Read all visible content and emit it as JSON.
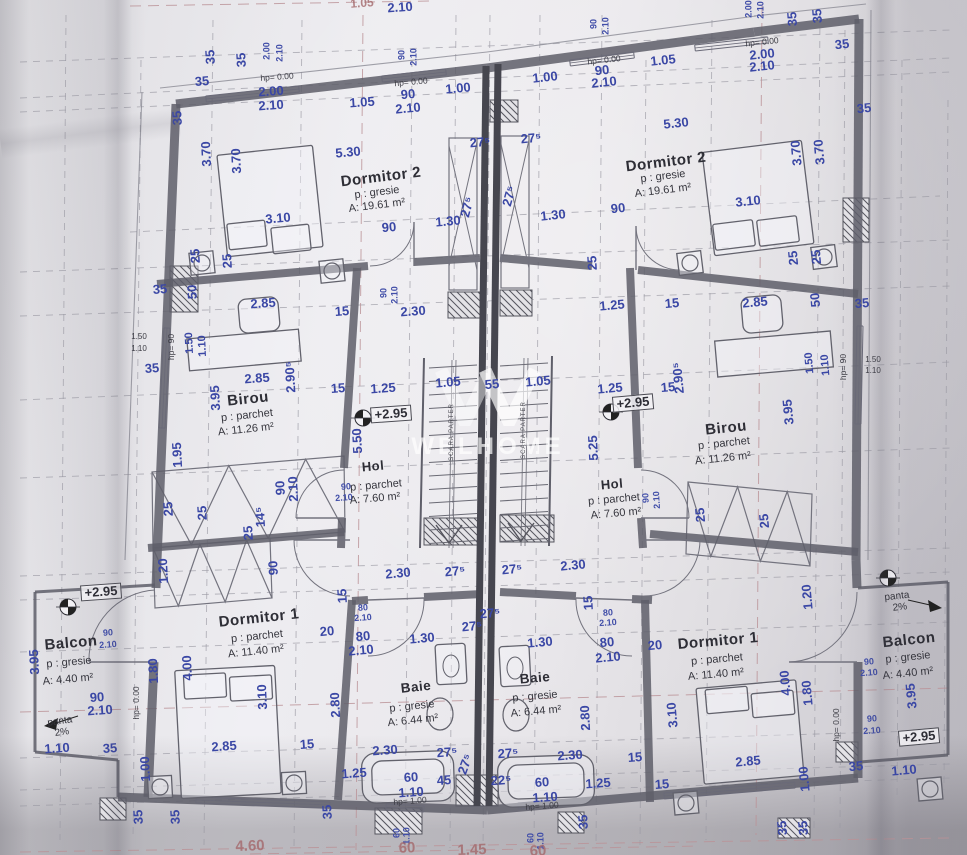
{
  "sheet": {
    "watermark": "WELHOME",
    "stair_label": "SCARA PARTER",
    "level_mark": "+2.95"
  },
  "rooms": [
    {
      "name": "Dormitor 2",
      "floor": "p : gresie",
      "area": "A: 19.61 m²"
    },
    {
      "name": "Birou",
      "floor": "p : parchet",
      "area": "A: 11.26 m²"
    },
    {
      "name": "Hol",
      "floor": "p : parchet",
      "area": "A: 7.60 m²"
    },
    {
      "name": "Dormitor 1",
      "floor": "p : parchet",
      "area": "A: 11.40 m²"
    },
    {
      "name": "Baie",
      "floor": "p : gresie",
      "area": "A: 6.44 m²"
    },
    {
      "name": "Balcon",
      "floor": "p : gresie",
      "area": "A: 4.40 m²"
    }
  ],
  "colors": {
    "dim_blue": "#3a47a5",
    "room_text": "#2e2e36",
    "wall": "#5f5f6a",
    "grid_gray": "#9a99a3",
    "grid_red": "#bb9297",
    "red_dim": "#a4696c"
  },
  "labels": [
    [
      "1.05",
      362,
      3,
      -4,
      "red",
      12
    ],
    [
      "2.10",
      400,
      7,
      -4,
      "d"
    ],
    [
      "35",
      210,
      57,
      -93,
      "d"
    ],
    [
      "35",
      241,
      60,
      -93,
      "d"
    ],
    [
      "2.00",
      267,
      51,
      -90,
      "ds"
    ],
    [
      "2.10",
      280,
      53,
      -90,
      "ds"
    ],
    [
      "35",
      202,
      81,
      -4,
      "d"
    ],
    [
      "hp= 0.00",
      277,
      77,
      -4,
      "h"
    ],
    [
      "2.00",
      271,
      91,
      -4,
      "d"
    ],
    [
      "2.10",
      271,
      105,
      -4,
      "d"
    ],
    [
      "1.05",
      362,
      102,
      -4,
      "d"
    ],
    [
      "90",
      402,
      55,
      -90,
      "ds"
    ],
    [
      "2.10",
      414,
      57,
      -90,
      "ds"
    ],
    [
      "hp= 0.00",
      411,
      82,
      -5,
      "h"
    ],
    [
      "90",
      408,
      94,
      -5,
      "d"
    ],
    [
      "2.10",
      408,
      108,
      -5,
      "d"
    ],
    [
      "1.00",
      458,
      88,
      -5,
      "d"
    ],
    [
      "1.00",
      545,
      77,
      -6,
      "d"
    ],
    [
      "90",
      594,
      24,
      -90,
      "ds"
    ],
    [
      "2.10",
      606,
      26,
      -90,
      "ds"
    ],
    [
      "hp= 0.00",
      604,
      60,
      -6,
      "h"
    ],
    [
      "90",
      602,
      70,
      -6,
      "d"
    ],
    [
      "2.10",
      604,
      82,
      -6,
      "d"
    ],
    [
      "1.05",
      663,
      60,
      -6,
      "d"
    ],
    [
      "2.00",
      749,
      9,
      -90,
      "ds"
    ],
    [
      "2.10",
      761,
      10,
      -90,
      "ds"
    ],
    [
      "hp= 0.00",
      762,
      42,
      -6,
      "h"
    ],
    [
      "2.00",
      762,
      54,
      -6,
      "d"
    ],
    [
      "2.10",
      762,
      66,
      -6,
      "d"
    ],
    [
      "35",
      792,
      19,
      -94,
      "d"
    ],
    [
      "35",
      817,
      16,
      -94,
      "d"
    ],
    [
      "35",
      842,
      44,
      -6,
      "d"
    ],
    [
      "35",
      864,
      108,
      -6,
      "d"
    ],
    [
      "5.30",
      676,
      123,
      -6,
      "d"
    ],
    [
      "35",
      177,
      118,
      -93,
      "d"
    ],
    [
      "3.70",
      206,
      154,
      -93,
      "d"
    ],
    [
      "3.70",
      236,
      161,
      -93,
      "d"
    ],
    [
      "5.30",
      348,
      152,
      -5,
      "d"
    ],
    [
      "Dormitor 2",
      381,
      177,
      -7,
      "r"
    ],
    [
      "p : gresie",
      377,
      193,
      -7,
      "rs"
    ],
    [
      "A: 19.61 m²",
      377,
      206,
      -7,
      "rs"
    ],
    [
      "3.10",
      278,
      218,
      -5,
      "d"
    ],
    [
      "90",
      389,
      227,
      -5,
      "d"
    ],
    [
      "1.30",
      448,
      221,
      -5,
      "d"
    ],
    [
      "27⁵",
      480,
      142,
      -5,
      "d"
    ],
    [
      "27⁵",
      531,
      138,
      -5,
      "d"
    ],
    [
      "27⁵",
      467,
      207,
      -75,
      "d"
    ],
    [
      "27⁵",
      509,
      196,
      -75,
      "d"
    ],
    [
      "Dormitor 2",
      666,
      162,
      -7,
      "r"
    ],
    [
      "p : gresie",
      663,
      177,
      -7,
      "rs"
    ],
    [
      "A: 19.61 m²",
      663,
      191,
      -7,
      "rs"
    ],
    [
      "1.30",
      553,
      215,
      -6,
      "d"
    ],
    [
      "90",
      618,
      208,
      -6,
      "d"
    ],
    [
      "3.10",
      748,
      201,
      -6,
      "d"
    ],
    [
      "3.70",
      796,
      153,
      -95,
      "d"
    ],
    [
      "3.70",
      819,
      152,
      -95,
      "d"
    ],
    [
      "25",
      195,
      256,
      -93,
      "d"
    ],
    [
      "25",
      227,
      261,
      -93,
      "d"
    ],
    [
      "25",
      592,
      263,
      -93,
      "d"
    ],
    [
      "25",
      793,
      258,
      -95,
      "d"
    ],
    [
      "25",
      816,
      257,
      -95,
      "d"
    ],
    [
      "35",
      160,
      289,
      -4,
      "d"
    ],
    [
      "50",
      192,
      292,
      -93,
      "d"
    ],
    [
      "2.85",
      263,
      303,
      -4,
      "d"
    ],
    [
      "15",
      342,
      311,
      -4,
      "d"
    ],
    [
      "2.30",
      413,
      311,
      -4,
      "d"
    ],
    [
      "90",
      384,
      293,
      -90,
      "ds"
    ],
    [
      "2.10",
      395,
      295,
      -90,
      "ds"
    ],
    [
      "1.25",
      612,
      305,
      -5,
      "d"
    ],
    [
      "15",
      672,
      303,
      -5,
      "d"
    ],
    [
      "2.85",
      755,
      302,
      -5,
      "d"
    ],
    [
      "50",
      815,
      300,
      -95,
      "d"
    ],
    [
      "35",
      862,
      303,
      -5,
      "d"
    ],
    [
      "1.50",
      139,
      337,
      0,
      "tiny"
    ],
    [
      "1.10",
      139,
      349,
      0,
      "tiny"
    ],
    [
      "hp= 90",
      171,
      347,
      -90,
      "h"
    ],
    [
      "1.50",
      190,
      343,
      -93,
      "d",
      11
    ],
    [
      "1.10",
      203,
      346,
      -93,
      "d",
      11
    ],
    [
      "35",
      152,
      368,
      -4,
      "d"
    ],
    [
      "2.85",
      257,
      378,
      -4,
      "d"
    ],
    [
      "2.90⁵",
      290,
      377,
      -93,
      "d"
    ],
    [
      "3.95",
      215,
      398,
      -93,
      "d"
    ],
    [
      "15",
      338,
      388,
      -4,
      "d"
    ],
    [
      "1.25",
      383,
      388,
      -4,
      "d"
    ],
    [
      "Birou",
      248,
      399,
      -6,
      "r"
    ],
    [
      "p : parchet",
      247,
      416,
      -6,
      "rs"
    ],
    [
      "A: 11.26 m²",
      246,
      430,
      -6,
      "rs"
    ],
    [
      "+2.95",
      391,
      414,
      -4,
      "box"
    ],
    [
      "1.05",
      448,
      382,
      -5,
      "d"
    ],
    [
      "55",
      492,
      384,
      -5,
      "d"
    ],
    [
      "1.05",
      538,
      381,
      -5,
      "d"
    ],
    [
      "1.25",
      610,
      388,
      -5,
      "d"
    ],
    [
      "+2.95",
      633,
      403,
      -5,
      "box"
    ],
    [
      "15",
      668,
      387,
      -5,
      "d"
    ],
    [
      "2.90⁵",
      678,
      378,
      -95,
      "d"
    ],
    [
      "1.50",
      810,
      363,
      -95,
      "d",
      11
    ],
    [
      "1.10",
      826,
      365,
      -95,
      "d",
      11
    ],
    [
      "hp= 90",
      843,
      367,
      -90,
      "h"
    ],
    [
      "1.50",
      873,
      360,
      0,
      "tiny"
    ],
    [
      "1.10",
      873,
      371,
      0,
      "tiny"
    ],
    [
      "3.95",
      788,
      412,
      -95,
      "d"
    ],
    [
      "Birou",
      726,
      428,
      -6,
      "r"
    ],
    [
      "p : parchet",
      724,
      444,
      -6,
      "rs"
    ],
    [
      "A: 11.26 m²",
      723,
      459,
      -6,
      "rs"
    ],
    [
      "5.50",
      357,
      441,
      -93,
      "d"
    ],
    [
      "5.25",
      593,
      448,
      -93,
      "d"
    ],
    [
      "Hol",
      373,
      466,
      -5,
      "r",
      13
    ],
    [
      "90",
      346,
      487,
      -4,
      "ds"
    ],
    [
      "2.10",
      344,
      498,
      -4,
      "ds"
    ],
    [
      "p : parchet",
      376,
      486,
      -5,
      "rs"
    ],
    [
      "A: 7.60 m²",
      375,
      499,
      -5,
      "rs"
    ],
    [
      "Hol",
      612,
      484,
      -5,
      "r",
      13
    ],
    [
      "p : parchet",
      614,
      500,
      -5,
      "rs"
    ],
    [
      "A: 7.60 m²",
      616,
      514,
      -5,
      "rs"
    ],
    [
      "1.95",
      177,
      455,
      -93,
      "d"
    ],
    [
      "SCARA PARTER",
      452,
      432,
      -90,
      "st"
    ],
    [
      "SCARA PARTER",
      524,
      430,
      -90,
      "st"
    ],
    [
      "25",
      168,
      509,
      -93,
      "d"
    ],
    [
      "25",
      202,
      513,
      -93,
      "d"
    ],
    [
      "14⁵",
      260,
      517,
      -93,
      "d"
    ],
    [
      "25",
      248,
      533,
      -93,
      "d"
    ],
    [
      "90",
      280,
      488,
      -93,
      "d"
    ],
    [
      "2.10",
      293,
      489,
      -93,
      "d"
    ],
    [
      "90",
      273,
      568,
      -93,
      "d"
    ],
    [
      "1.20",
      163,
      571,
      -93,
      "d"
    ],
    [
      "2.30",
      398,
      573,
      -5,
      "d"
    ],
    [
      "27⁵",
      455,
      571,
      -5,
      "d"
    ],
    [
      "27⁵",
      512,
      569,
      -5,
      "d"
    ],
    [
      "2.30",
      573,
      565,
      -5,
      "d"
    ],
    [
      "90",
      646,
      498,
      -93,
      "ds"
    ],
    [
      "2.10",
      657,
      500,
      -93,
      "ds"
    ],
    [
      "25",
      700,
      515,
      -95,
      "d"
    ],
    [
      "25",
      764,
      521,
      -95,
      "d"
    ],
    [
      "1.20",
      807,
      597,
      -95,
      "d"
    ],
    [
      "15",
      342,
      596,
      -93,
      "d"
    ],
    [
      "80",
      363,
      608,
      -4,
      "ds"
    ],
    [
      "2.10",
      363,
      618,
      -4,
      "ds"
    ],
    [
      "15",
      588,
      603,
      -93,
      "d"
    ],
    [
      "80",
      608,
      613,
      -4,
      "ds"
    ],
    [
      "2.10",
      608,
      623,
      -4,
      "ds"
    ],
    [
      "Dormitor 1",
      259,
      618,
      -6,
      "r"
    ],
    [
      "p : parchet",
      257,
      637,
      -6,
      "rs"
    ],
    [
      "A: 11.40 m²",
      256,
      652,
      -6,
      "rs"
    ],
    [
      "20",
      327,
      631,
      -5,
      "d"
    ],
    [
      "80",
      363,
      636,
      -5,
      "d"
    ],
    [
      "2.10",
      361,
      650,
      -5,
      "d"
    ],
    [
      "1.30",
      422,
      638,
      -5,
      "d"
    ],
    [
      "27⁵",
      490,
      613,
      -5,
      "d"
    ],
    [
      "27⁵",
      472,
      626,
      -5,
      "d"
    ],
    [
      "1.30",
      540,
      642,
      -5,
      "d"
    ],
    [
      "80",
      607,
      642,
      -5,
      "d"
    ],
    [
      "2.10",
      608,
      657,
      -5,
      "d"
    ],
    [
      "20",
      655,
      645,
      -5,
      "d"
    ],
    [
      "Dormitor 1",
      718,
      641,
      -5,
      "r"
    ],
    [
      "p : parchet",
      717,
      660,
      -5,
      "rs"
    ],
    [
      "A: 11.40 m²",
      716,
      675,
      -5,
      "rs"
    ],
    [
      "1.80",
      153,
      671,
      -93,
      "d"
    ],
    [
      "4.00",
      187,
      668,
      -93,
      "d"
    ],
    [
      "3.10",
      262,
      697,
      -93,
      "d"
    ],
    [
      "2.80",
      335,
      705,
      -93,
      "d"
    ],
    [
      "Baie",
      416,
      687,
      -6,
      "r",
      13.5
    ],
    [
      "p : gresie",
      412,
      707,
      -6,
      "rs"
    ],
    [
      "A: 6.44 m²",
      413,
      721,
      -6,
      "rs"
    ],
    [
      "Baie",
      535,
      678,
      -5,
      "r",
      13.5
    ],
    [
      "p : gresie",
      535,
      697,
      -5,
      "rs"
    ],
    [
      "A: 6.44 m²",
      536,
      712,
      -5,
      "rs"
    ],
    [
      "2.80",
      585,
      718,
      -93,
      "d"
    ],
    [
      "3.10",
      672,
      715,
      -95,
      "d"
    ],
    [
      "4.00",
      785,
      683,
      -95,
      "d"
    ],
    [
      "1.80",
      807,
      693,
      -95,
      "d"
    ],
    [
      "hp= 0.00",
      836,
      725,
      -90,
      "h"
    ],
    [
      "hp= 0.00",
      136,
      703,
      -90,
      "h"
    ],
    [
      "+2.95",
      101,
      592,
      -4,
      "box"
    ],
    [
      "Balcon",
      71,
      643,
      -5,
      "r"
    ],
    [
      "90",
      108,
      633,
      -4,
      "ds"
    ],
    [
      "2.10",
      108,
      645,
      -4,
      "ds"
    ],
    [
      "p : gresie",
      69,
      663,
      -5,
      "rs"
    ],
    [
      "A: 4.40 m²",
      68,
      680,
      -5,
      "rs"
    ],
    [
      "3.95",
      34,
      662,
      -93,
      "d"
    ],
    [
      "90",
      97,
      697,
      -4,
      "d"
    ],
    [
      "2.10",
      100,
      710,
      -4,
      "d"
    ],
    [
      "panta",
      60,
      722,
      -8,
      "rs",
      10
    ],
    [
      "2%",
      62,
      733,
      -8,
      "rs",
      10
    ],
    [
      "1.10",
      57,
      748,
      -4,
      "d"
    ],
    [
      "35",
      110,
      748,
      -4,
      "d"
    ],
    [
      "1.00",
      145,
      769,
      -93,
      "d"
    ],
    [
      "panta",
      897,
      597,
      -6,
      "rs",
      10
    ],
    [
      "2%",
      900,
      608,
      -6,
      "rs",
      10
    ],
    [
      "Balcon",
      909,
      640,
      -6,
      "r"
    ],
    [
      "90",
      869,
      662,
      -4,
      "ds"
    ],
    [
      "2.10",
      869,
      673,
      -4,
      "ds"
    ],
    [
      "p : gresie",
      908,
      658,
      -6,
      "rs"
    ],
    [
      "A: 4.40 m²",
      908,
      674,
      -6,
      "rs"
    ],
    [
      "3.95",
      911,
      696,
      -95,
      "d"
    ],
    [
      "90",
      872,
      719,
      -4,
      "ds"
    ],
    [
      "2.10",
      872,
      731,
      -4,
      "ds"
    ],
    [
      "+2.95",
      919,
      737,
      -5,
      "box"
    ],
    [
      "35",
      856,
      766,
      -5,
      "d"
    ],
    [
      "1.10",
      904,
      770,
      -5,
      "d"
    ],
    [
      "1.00",
      804,
      779,
      -95,
      "d"
    ],
    [
      "2.85",
      224,
      746,
      -4,
      "d"
    ],
    [
      "15",
      307,
      744,
      -4,
      "d"
    ],
    [
      "2.30",
      385,
      750,
      -4,
      "d"
    ],
    [
      "27⁵",
      447,
      752,
      -4,
      "d"
    ],
    [
      "27⁵",
      465,
      764,
      -70,
      "d"
    ],
    [
      "27⁵",
      508,
      753,
      -4,
      "d"
    ],
    [
      "2.30",
      570,
      755,
      -4,
      "d"
    ],
    [
      "15",
      635,
      757,
      -4,
      "d"
    ],
    [
      "2.85",
      748,
      761,
      -5,
      "d"
    ],
    [
      "1.25",
      354,
      773,
      -4,
      "d"
    ],
    [
      "60",
      411,
      777,
      -4,
      "d"
    ],
    [
      "45",
      444,
      780,
      -4,
      "d"
    ],
    [
      "22⁵",
      501,
      780,
      -4,
      "d"
    ],
    [
      "60",
      542,
      782,
      -4,
      "d"
    ],
    [
      "1.25",
      598,
      783,
      -4,
      "d"
    ],
    [
      "15",
      662,
      784,
      -4,
      "d"
    ],
    [
      "1.10",
      411,
      792,
      -4,
      "d"
    ],
    [
      "hp= 1.00",
      410,
      801,
      -4,
      "h"
    ],
    [
      "1.10",
      545,
      797,
      -4,
      "d"
    ],
    [
      "hp= 1.00",
      542,
      806,
      -4,
      "h"
    ],
    [
      "35",
      138,
      817,
      -93,
      "d"
    ],
    [
      "35",
      175,
      817,
      -93,
      "d"
    ],
    [
      "35",
      327,
      812,
      -93,
      "d"
    ],
    [
      "35",
      583,
      822,
      -93,
      "d"
    ],
    [
      "60",
      397,
      833,
      -90,
      "ds"
    ],
    [
      "1.10",
      407,
      836,
      -90,
      "ds"
    ],
    [
      "60",
      531,
      838,
      -90,
      "ds"
    ],
    [
      "1.10",
      541,
      841,
      -90,
      "ds"
    ],
    [
      "35",
      782,
      828,
      -95,
      "d"
    ],
    [
      "35",
      803,
      828,
      -95,
      "d"
    ],
    [
      "4.60",
      250,
      846,
      -2,
      "red"
    ],
    [
      "60",
      407,
      848,
      -2,
      "red"
    ],
    [
      "1.45",
      472,
      850,
      -2,
      "red"
    ],
    [
      "60",
      538,
      851,
      -2,
      "red"
    ]
  ]
}
